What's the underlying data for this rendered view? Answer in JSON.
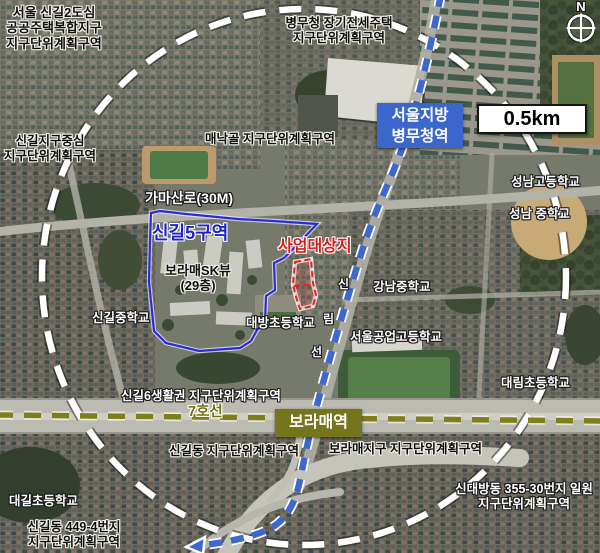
{
  "map": {
    "compass": {
      "label": "N"
    },
    "scale_bar": {
      "label": "0.5km"
    },
    "subway": {
      "name_chars": {
        "c1": "신",
        "c2": "림",
        "c3": "선"
      },
      "line7_label": "7호선"
    },
    "stations": {
      "byeongmucheong": {
        "line1": "서울지방",
        "line2": "병무청역"
      },
      "boramae": {
        "label": "보라매역"
      }
    },
    "zones": {
      "singil5": {
        "label": "신길5구역"
      },
      "site": {
        "label": "사업대상지"
      }
    },
    "roads": {
      "gamasan": "가마산로(30M)"
    },
    "district_labels": {
      "singil2": {
        "line1": "서울 신길2도심",
        "line2": "공공주택복합지구",
        "line3": "지구단위계획구역"
      },
      "byeongmu_housing": {
        "line1": "병무청 장기전세주택",
        "line2": "지구단위계획구역"
      },
      "maenakgol": {
        "line1": "매낙골 지구단위계획구역"
      },
      "singil_center": {
        "line1": "신길지구중심",
        "line2": "지구단위계획구역"
      },
      "singil6": {
        "line1": "신길6생활권 지구단위계획구역"
      },
      "singildong": {
        "line1": "신길동 지구단위계획구역"
      },
      "boramae_district": {
        "line1": "보라매지구 지구단위계획구역"
      },
      "sindaebang": {
        "line1": "신대방동 355-30번지 일원",
        "line2": "지구단위계획구역"
      },
      "singil449": {
        "line1": "신길동 449-4번지",
        "line2": "지구단위계획구역"
      }
    },
    "buildings": {
      "boramae_sk": {
        "line1": "보라매SK뷰",
        "line2": "(29층)"
      }
    },
    "schools": {
      "singil_middle": "신길중학교",
      "daebang_elem": "대방초등학교",
      "gangnam_middle": "강남중학교",
      "seongnam_high": "성남고등학교",
      "seongnam_middle": "성남 중학교",
      "seoul_tech_high": "서울공업고등학교",
      "daerim_elem": "대림초등학교",
      "daegil_elem": "대길초등학교"
    },
    "colors": {
      "site_red": "#e8221c",
      "zone_blue": "#2b2bdd",
      "subway_blue": "#3e68cf",
      "line7_olive": "#7e7e1a",
      "circle_white": "#ffffff",
      "byeongmucheong_station_bg": "#3b66cb",
      "boramae_station_bg": "#75751e"
    }
  }
}
